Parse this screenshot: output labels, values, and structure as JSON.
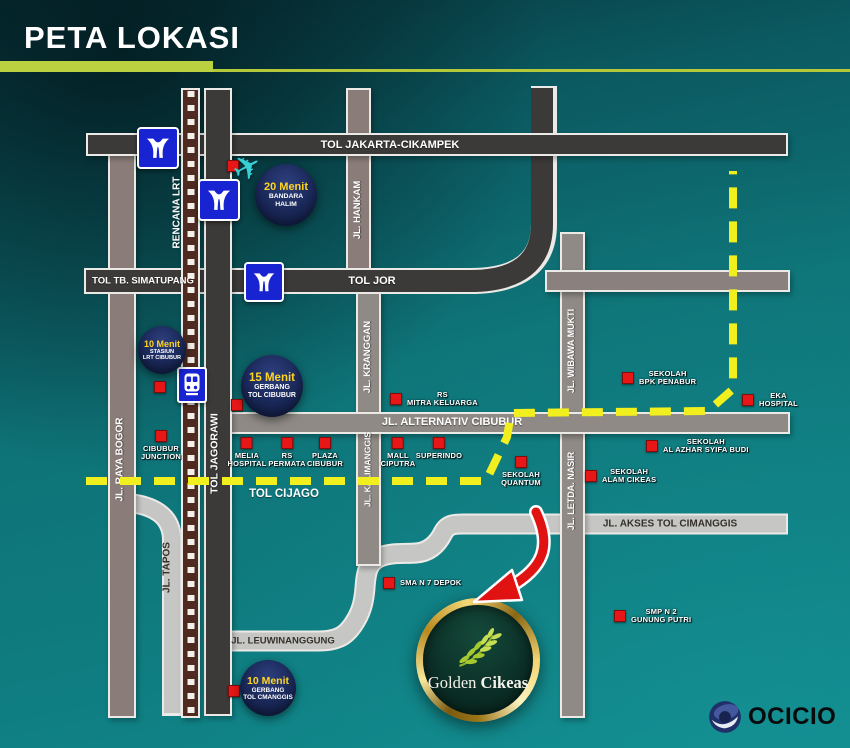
{
  "header": {
    "title": "PETA LOKASI"
  },
  "roads": {
    "tol_jakarta_cikampek": "TOL JAKARTA-CIKAMPEK",
    "tol_tb_simatupang": "TOL TB. SIMATUPANG",
    "tol_jor": "TOL JOR",
    "jl_alternativ_cibubur": "JL. ALTERNATIV CIBUBUR",
    "tol_cijago": "TOL CIJAGO",
    "jl_akses_tol_cimanggis": "JL. AKSES TOL CIMANGGIS",
    "jl_leuwinanggung": "JL. LEUWINANGGUNG",
    "jl_raya_bogor": "JL. RAYA BOGOR",
    "rencana_lrt": "RENCANA LRT",
    "tol_jagorawi": "TOL JAGORAWI",
    "jl_tapos": "JL. TAPOS",
    "jl_hankam": "JL. HANKAM",
    "jl_kranggan": "JL. KRANGGAN",
    "jl_kalimanggis": "JL. KALIMANGGIS",
    "jl_wibawa_mukti": "JL. WIBAWA MUKTI",
    "jl_letda_nasir": "JL. LETDA. NASIR"
  },
  "badges": [
    {
      "time": "20 Menit",
      "line1": "BANDARA",
      "line2": "HALIM"
    },
    {
      "time": "10 Menit",
      "line1": "STASIUN",
      "line2": "LRT CIBUBUR"
    },
    {
      "time": "15 Menit",
      "line1": "GERBANG",
      "line2": "TOL CIBUBUR"
    },
    {
      "time": "10 Menit",
      "line1": "GERBANG",
      "line2": "TOL CMANGGIS"
    }
  ],
  "pois": [
    {
      "line1": "RS",
      "line2": "MITRA KELUARGA"
    },
    {
      "line1": "MELIA",
      "line2": "HOSPITAL"
    },
    {
      "line1": "RS",
      "line2": "PERMATA"
    },
    {
      "line1": "PLAZA",
      "line2": "CIBUBUR"
    },
    {
      "line1": "MALL",
      "line2": "CIPUTRA"
    },
    {
      "line1": "SUPERINDO"
    },
    {
      "line1": "SEKOLAH",
      "line2": "QUANTUM"
    },
    {
      "line1": "SEKOLAH",
      "line2": "ALAM CIKEAS"
    },
    {
      "line1": "SEKOLAH",
      "line2": "AL AZHAR SYIFA BUDI"
    },
    {
      "line1": "SEKOLAH",
      "line2": "BPK PENABUR"
    },
    {
      "line1": "EKA",
      "line2": "HOSPITAL"
    },
    {
      "line1": "SMA N 7 DEPOK"
    },
    {
      "line1": "SMP N 2",
      "line2": "GUNUNG PUTRI"
    },
    {
      "line1": "CIBUBUR",
      "line2": "JUNCTION"
    }
  ],
  "landmark": {
    "name_regular": "Golden",
    "name_bold": "Cikeas"
  },
  "footer": {
    "brand": "OCICIO"
  },
  "icons": {
    "plane_glyph": "✈"
  },
  "colors": {
    "background_teal": "#0e7578",
    "accent_lime": "#bcd13f",
    "road_dark": "#3b3a38",
    "road_gray": "#8f8a86",
    "road_light": "#c6c7c5",
    "railway_brown": "#4e2a20",
    "route_yellow": "#f2ef1e",
    "badge_navy": "#1b2a58",
    "badge_time_yellow": "#ffd61f",
    "marker_red": "#e81717",
    "logo_gold": "#e7c35f",
    "plane_cyan": "#38d0d4"
  }
}
